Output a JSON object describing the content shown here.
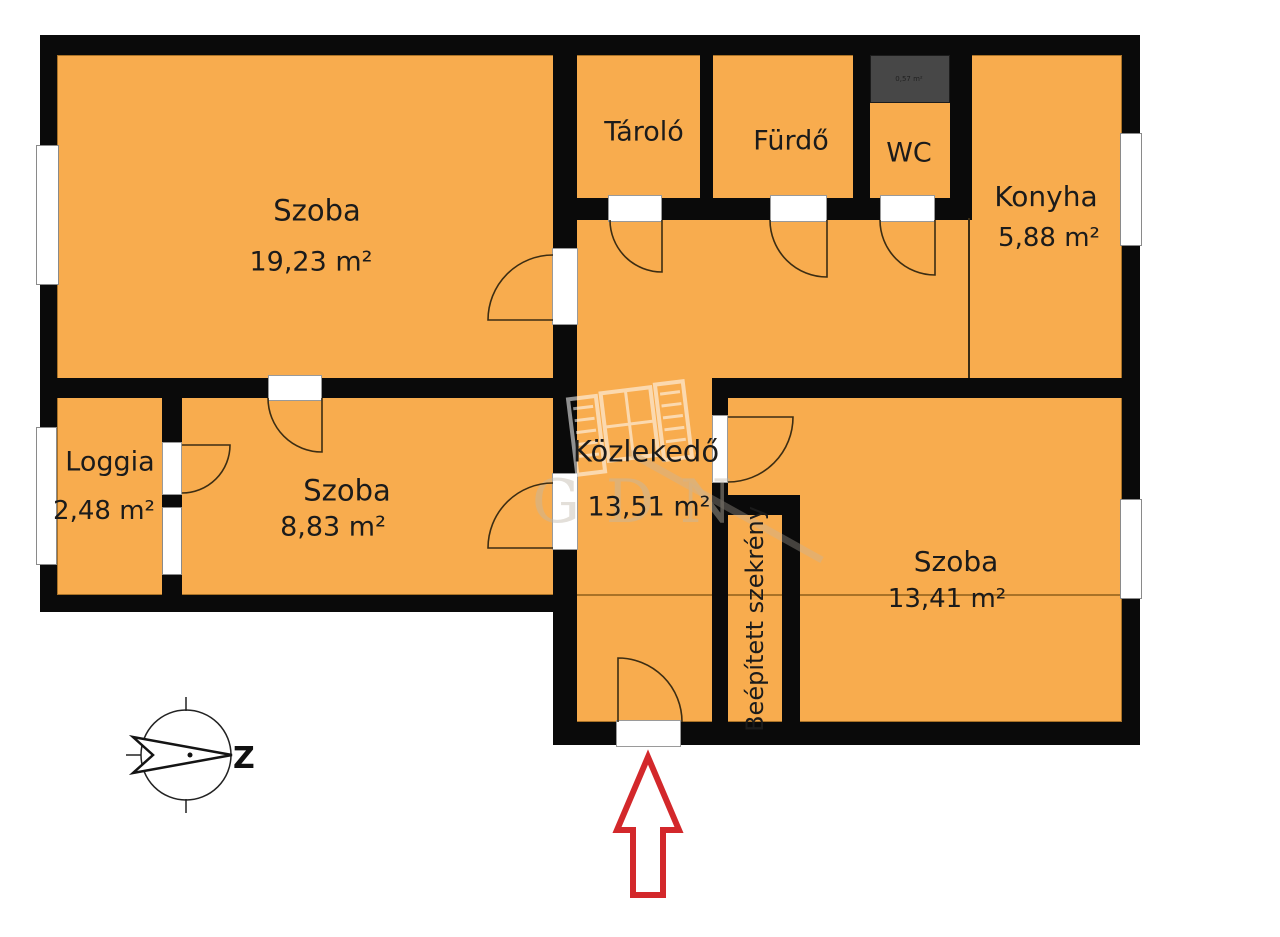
{
  "rooms": [
    {
      "name": "Szoba",
      "area": "19,23 m²"
    },
    {
      "name": "Tároló"
    },
    {
      "name": "Fürdő"
    },
    {
      "name": "WC"
    },
    {
      "name": "Konyha",
      "area": "5,88 m²"
    },
    {
      "name": "Közlekedő",
      "area": "13,51 m²"
    },
    {
      "name": "Loggia",
      "area": "2,48 m²"
    },
    {
      "name": "Szoba",
      "area": "8,83 m²"
    },
    {
      "name": "Szoba",
      "area": "13,41 m²"
    },
    {
      "name": "Beépített szekrény"
    }
  ],
  "shaft": {
    "label": "0,57 m²"
  },
  "compass": {
    "label": "Z"
  },
  "watermark": {
    "text": "GDN"
  },
  "colors": {
    "floor": "#F8AC4E",
    "wall": "#0A0A0A",
    "shaft": "#474747",
    "door_gap": "#FFFFFF",
    "entrance_arrow": "#D3282B"
  }
}
